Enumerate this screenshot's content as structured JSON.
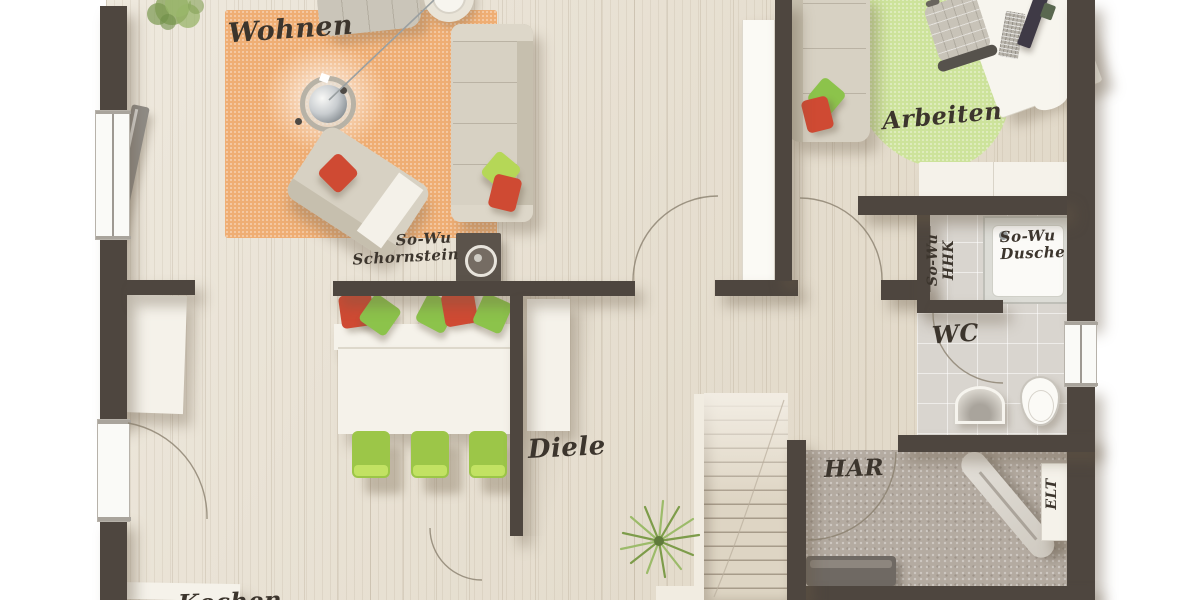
{
  "plan": {
    "type": "floor-plan",
    "rooms": [
      {
        "id": "wohnen",
        "label": "Wohnen"
      },
      {
        "id": "arbeiten",
        "label": "Arbeiten"
      },
      {
        "id": "diele",
        "label": "Diele"
      },
      {
        "id": "wc",
        "label": "WC"
      },
      {
        "id": "har",
        "label": "HAR"
      },
      {
        "id": "kochen",
        "label": "Kochen"
      }
    ],
    "annotations": {
      "schornstein": {
        "line1": "So-Wu",
        "line2": "Schornstein"
      },
      "dusche": {
        "line1": "So-Wu",
        "line2": "Dusche"
      },
      "hhk": {
        "line1": "So-Wu",
        "line2": "HHK"
      },
      "elt": {
        "label": "ELT"
      }
    }
  },
  "colors": {
    "wall": "#4e463f",
    "floor_wood": "#e7dfcf",
    "floor_tile": "#d9d5cf",
    "floor_har": "#b4aba1",
    "rug_orange": "#efae74",
    "rug_green": "#cde39b",
    "sofa_beige": "#d7d1c3",
    "sofa_back": "#c6bfae",
    "accent_red": "#cf4a33",
    "accent_green": "#8cc34b",
    "chair_green": "#9cc648",
    "furniture_white": "#f5f2ea",
    "label_ink": "#3c352d"
  }
}
